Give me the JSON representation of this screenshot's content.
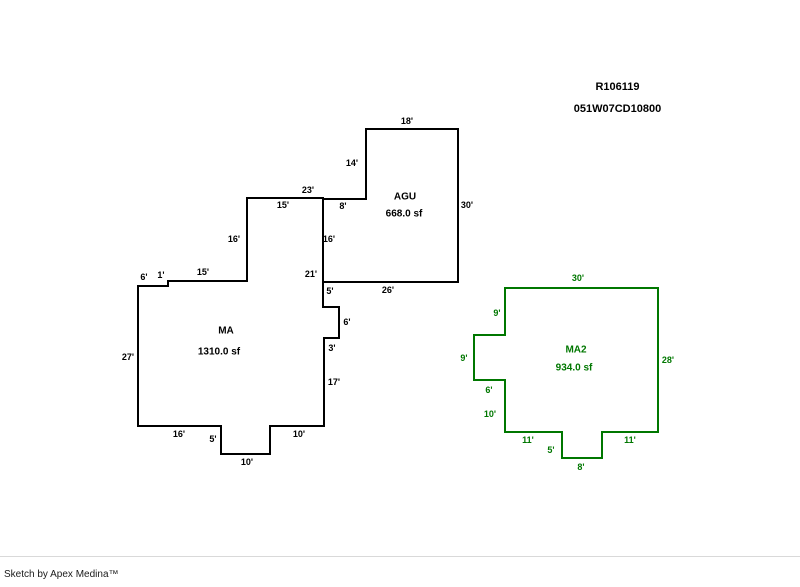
{
  "header": {
    "reference_number": "R106119",
    "parcel_id": "051W07CD10800"
  },
  "footer": {
    "credit": "Sketch by Apex Medina™"
  },
  "sketch": {
    "areas": [
      {
        "id": "ma",
        "label": "MA",
        "area_text": "1310.0 sf",
        "color": "#000000",
        "outline_points": "138,286 168,286 168,281 247,281 247,198 323,198 323,307 339,307 339,338 324,338 324,426 270,426 270,454 221,454 221,426 138,426",
        "label_x": 226,
        "label_y": 331,
        "area_x": 219,
        "area_y": 352,
        "dimensions": [
          {
            "text": "6'",
            "x": 144,
            "y": 277
          },
          {
            "text": "1'",
            "x": 161,
            "y": 275
          },
          {
            "text": "15'",
            "x": 203,
            "y": 272
          },
          {
            "text": "16'",
            "x": 234,
            "y": 239
          },
          {
            "text": "23'",
            "x": 308,
            "y": 190
          },
          {
            "text": "15'",
            "x": 283,
            "y": 205
          },
          {
            "text": "27'",
            "x": 128,
            "y": 357
          },
          {
            "text": "21'",
            "x": 311,
            "y": 274
          },
          {
            "text": "5'",
            "x": 330,
            "y": 291
          },
          {
            "text": "6'",
            "x": 347,
            "y": 322
          },
          {
            "text": "3'",
            "x": 332,
            "y": 348
          },
          {
            "text": "17'",
            "x": 334,
            "y": 382
          },
          {
            "text": "10'",
            "x": 299,
            "y": 434
          },
          {
            "text": "10'",
            "x": 247,
            "y": 462
          },
          {
            "text": "5'",
            "x": 213,
            "y": 439
          },
          {
            "text": "16'",
            "x": 179,
            "y": 434
          }
        ]
      },
      {
        "id": "agu",
        "label": "AGU",
        "area_text": "668.0 sf",
        "color": "#000000",
        "outline_points": "366,129 458,129 458,282 323,282 323,199 366,199",
        "label_x": 405,
        "label_y": 197,
        "area_x": 404,
        "area_y": 214,
        "dimensions": [
          {
            "text": "18'",
            "x": 407,
            "y": 121
          },
          {
            "text": "14'",
            "x": 352,
            "y": 163
          },
          {
            "text": "8'",
            "x": 343,
            "y": 206
          },
          {
            "text": "16'",
            "x": 329,
            "y": 239
          },
          {
            "text": "30'",
            "x": 467,
            "y": 205
          },
          {
            "text": "26'",
            "x": 388,
            "y": 290
          }
        ]
      },
      {
        "id": "ma2",
        "label": "MA2",
        "area_text": "934.0 sf",
        "color": "#007700",
        "outline_points": "505,288 658,288 658,432 602,432 602,458 562,458 562,432 505,432 505,380 474,380 474,335 505,335",
        "label_x": 576,
        "label_y": 350,
        "area_x": 574,
        "area_y": 368,
        "dimensions": [
          {
            "text": "30'",
            "x": 578,
            "y": 278
          },
          {
            "text": "9'",
            "x": 497,
            "y": 313
          },
          {
            "text": "9'",
            "x": 464,
            "y": 358
          },
          {
            "text": "6'",
            "x": 489,
            "y": 390
          },
          {
            "text": "10'",
            "x": 490,
            "y": 414
          },
          {
            "text": "28'",
            "x": 668,
            "y": 360
          },
          {
            "text": "11'",
            "x": 528,
            "y": 440
          },
          {
            "text": "5'",
            "x": 551,
            "y": 450
          },
          {
            "text": "8'",
            "x": 581,
            "y": 467
          },
          {
            "text": "11'",
            "x": 630,
            "y": 440
          }
        ]
      }
    ]
  }
}
